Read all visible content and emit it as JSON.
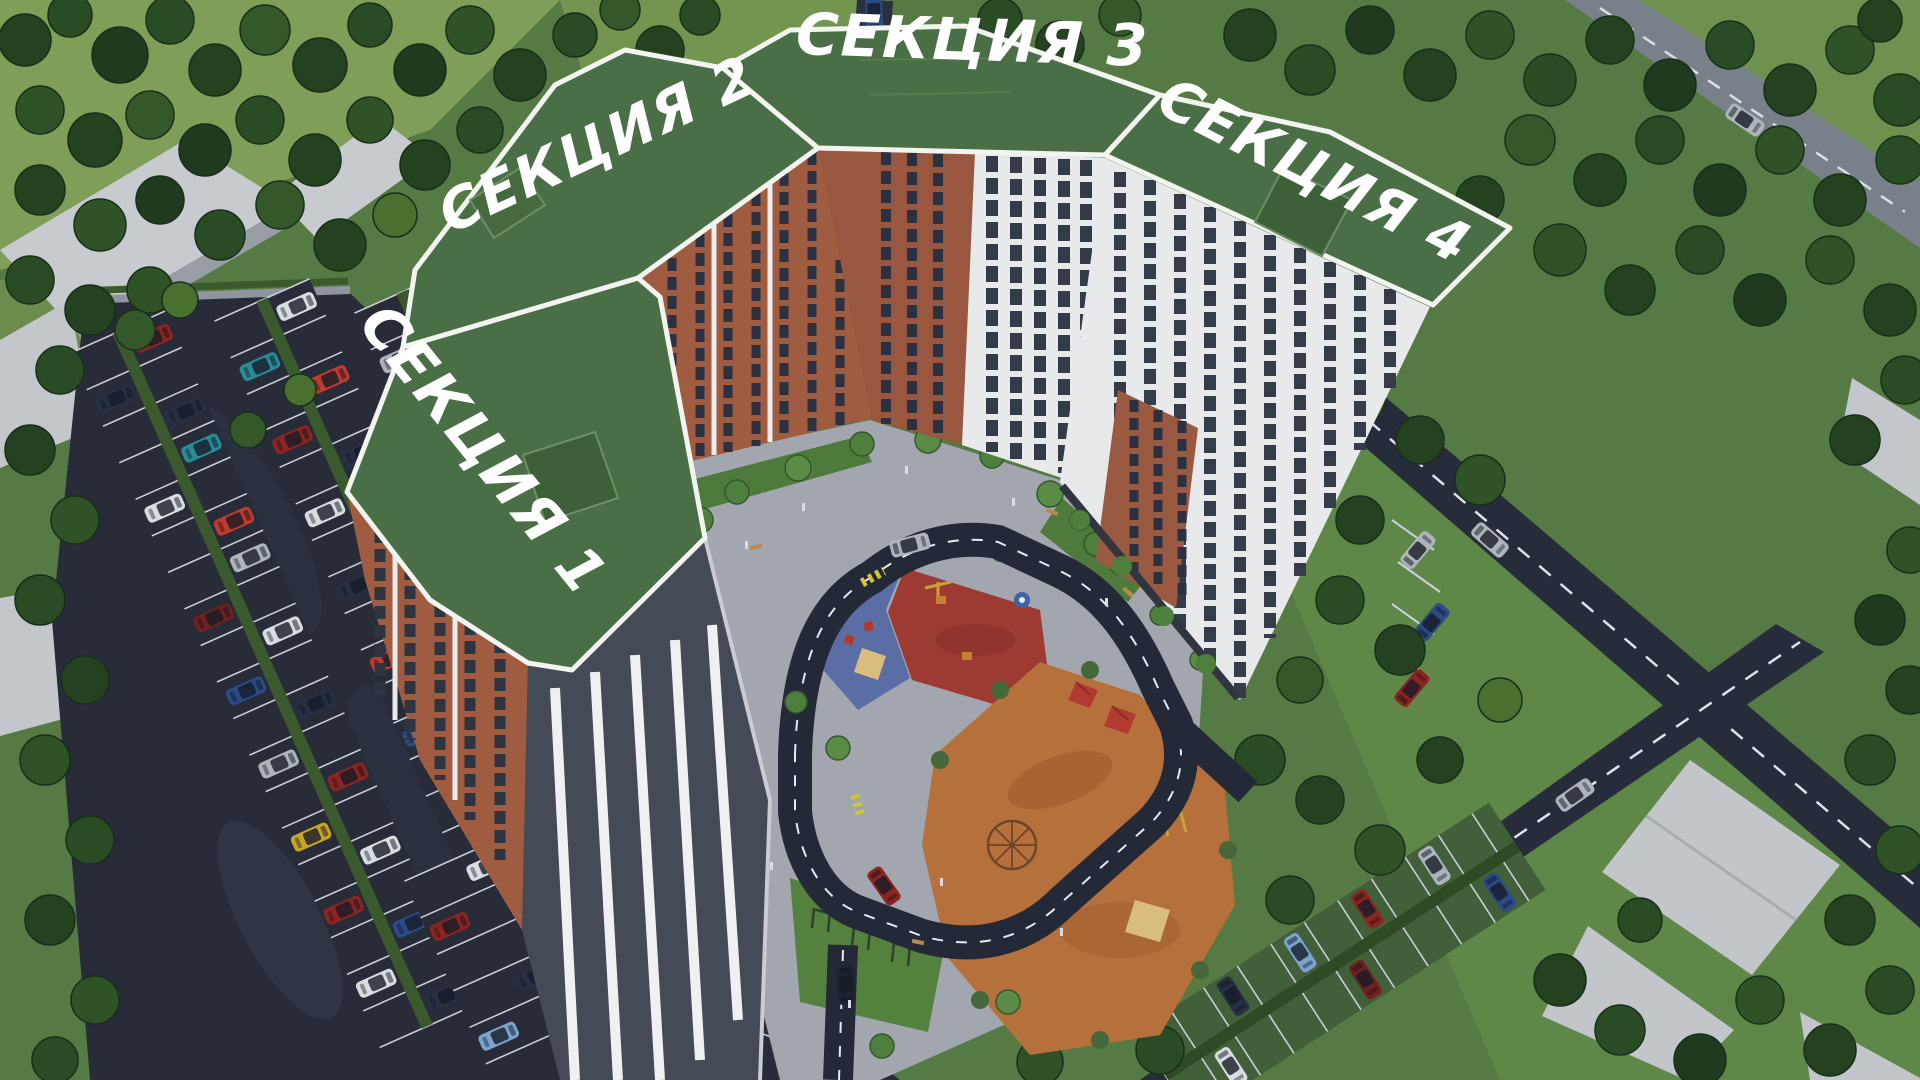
{
  "complex": {
    "sections": [
      {
        "number": "1",
        "label": "СЕКЦИЯ 1"
      },
      {
        "number": "2",
        "label": "СЕКЦИЯ 2"
      },
      {
        "number": "3",
        "label": "СЕКЦИЯ 3"
      },
      {
        "number": "4",
        "label": "СЕКЦИЯ 4"
      }
    ]
  },
  "colors": {
    "overlay_green": "#4a6e45",
    "overlay_border": "#f2f4ef",
    "label_text": "#ffffff",
    "brick_facade": "#a05c41",
    "white_facade": "#e7e9eb",
    "asphalt": "#272c38",
    "pavement": "#9aa0a9",
    "lawn": "#5a7d45",
    "forest_dark": "#24421f",
    "playground_red": "#9d3b33",
    "playground_blue": "#5a6da4",
    "playground_orange": "#b5703c",
    "playground_lawn": "#55813e"
  }
}
